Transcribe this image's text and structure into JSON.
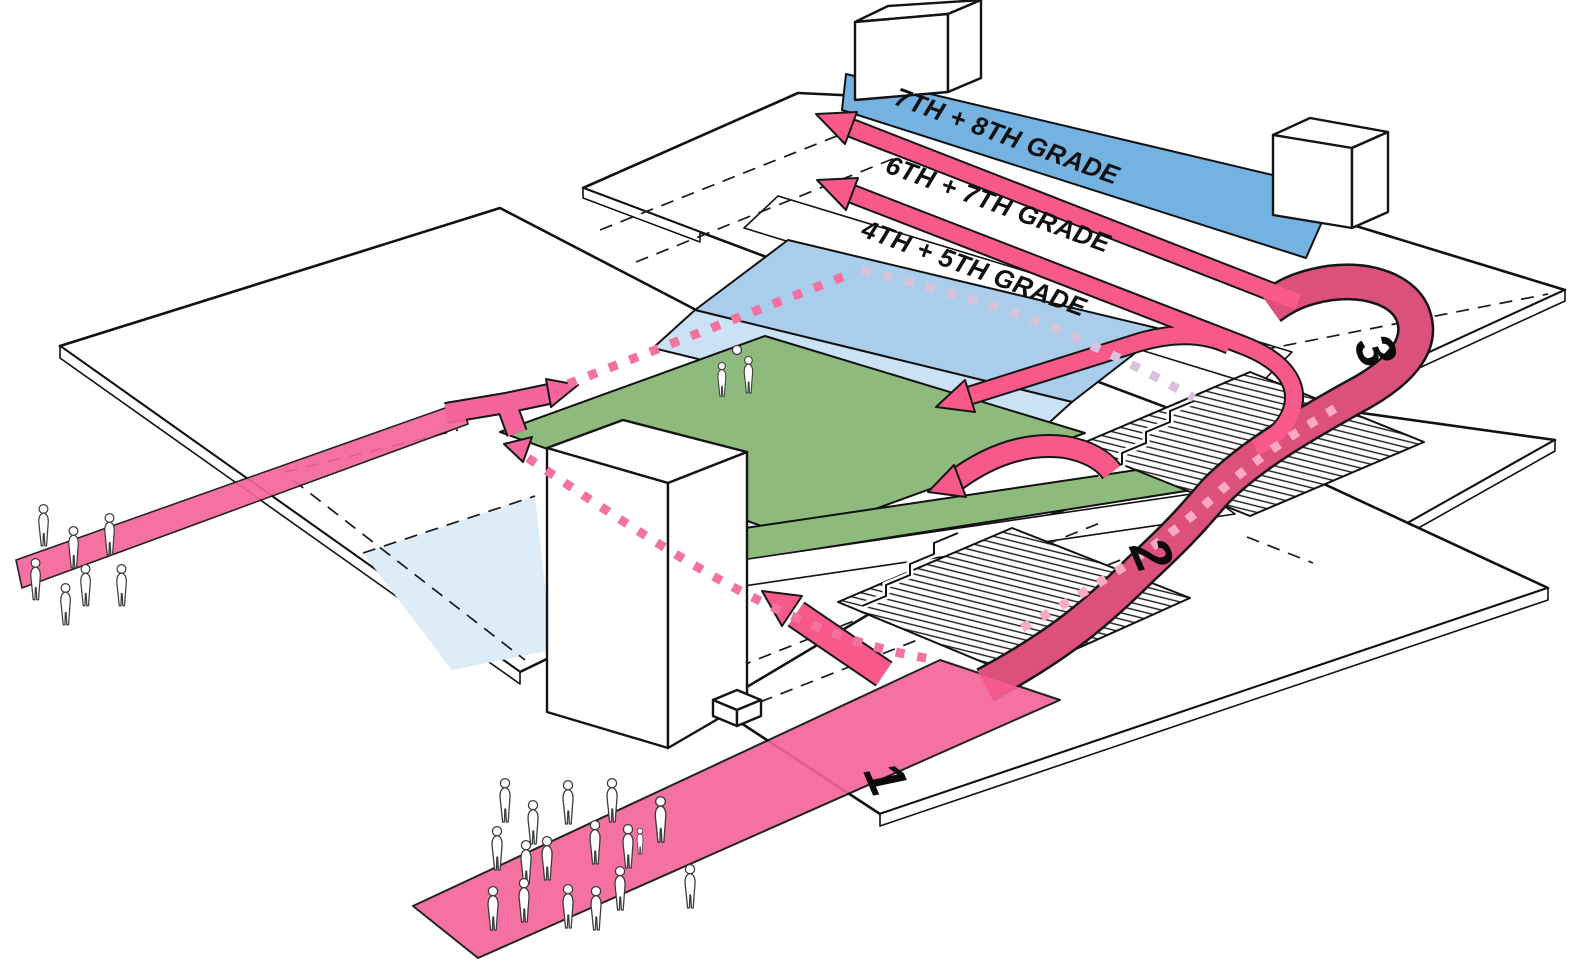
{
  "diagram": {
    "type": "axonometric-circulation-diagram",
    "subject": "stacked school floor plates with grade zones, grand stairs and pink circulation routes"
  },
  "palette": {
    "pink": "#F8598B",
    "pink_ramp": "#F4659B",
    "pink_dot": "#F472A0",
    "pink_dot_light": "#FBA9C4",
    "lavender_dot": "#D9C2DC",
    "grade_dark_blue": "#74B2E2",
    "grade_mid_blue": "#A9CDEA",
    "grade_light_blue": "#CBE2F4",
    "pale_blue": "#DCECF8",
    "grass_green": "#8FBA7D",
    "surface": "#FFFFFF",
    "outline": "#161616"
  },
  "grade_bands": [
    {
      "label": "7TH + 8TH GRADE"
    },
    {
      "label": "6TH + 7TH GRADE"
    },
    {
      "label": "4TH + 5TH GRADE"
    }
  ],
  "level_markers": [
    {
      "label": "1"
    },
    {
      "label": "2"
    },
    {
      "label": "3"
    }
  ],
  "icons": {
    "person": "person-icon",
    "ball": "ball-icon",
    "arrow": "circulation-arrow"
  }
}
